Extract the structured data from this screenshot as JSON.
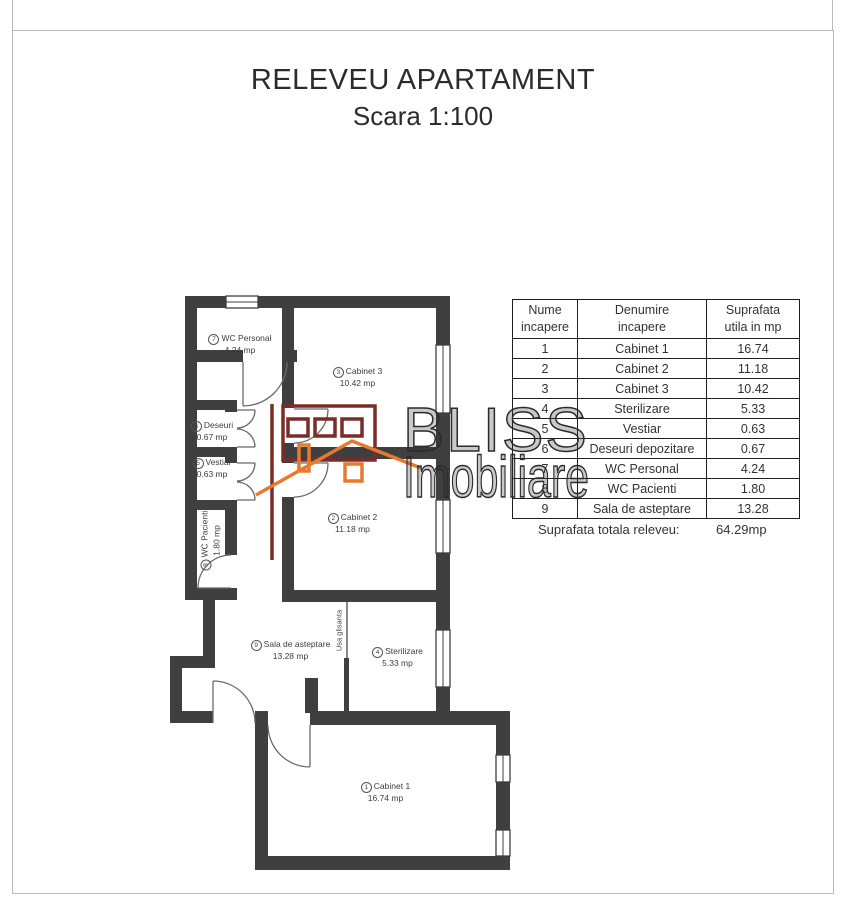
{
  "header": {
    "title": "RELEVEU APARTAMENT",
    "scale": "Scara 1:100"
  },
  "floor_plan": {
    "rooms": [
      {
        "badge": "7",
        "name": "WC Personal",
        "area": "4.24 mp"
      },
      {
        "badge": "3",
        "name": "Cabinet 3",
        "area": "10.42 mp"
      },
      {
        "badge": "6",
        "name": "Deseuri",
        "area": "0.67 mp"
      },
      {
        "badge": "5",
        "name": "Vestiar",
        "area": "0.63 mp"
      },
      {
        "badge": "8",
        "name": "WC Pacienti",
        "area": "1.80 mp"
      },
      {
        "badge": "2",
        "name": "Cabinet 2",
        "area": "11.18 mp"
      },
      {
        "badge": "9",
        "name": "Sala de asteptare",
        "area": "13.28 mp"
      },
      {
        "badge": "4",
        "name": "Sterilizare",
        "area": "5.33 mp"
      },
      {
        "badge": "1",
        "name": "Cabinet 1",
        "area": "16.74 mp"
      }
    ],
    "sliding_door_label": "Usa glisanta",
    "wall_color": "#3f3f3f"
  },
  "table": {
    "headers": [
      {
        "l1": "Nume",
        "l2": "incapere"
      },
      {
        "l1": "Denumire",
        "l2": "incapere"
      },
      {
        "l1": "Suprafata",
        "l2": "utila in mp"
      }
    ],
    "rows": [
      {
        "nr": "1",
        "name": "Cabinet 1",
        "area": "16.74"
      },
      {
        "nr": "2",
        "name": "Cabinet 2",
        "area": "11.18"
      },
      {
        "nr": "3",
        "name": "Cabinet 3",
        "area": "10.42"
      },
      {
        "nr": "4",
        "name": "Sterilizare",
        "area": "5.33"
      },
      {
        "nr": "5",
        "name": "Vestiar",
        "area": "0.63"
      },
      {
        "nr": "6",
        "name": "Deseuri depozitare",
        "area": "0.67"
      },
      {
        "nr": "7",
        "name": "WC Personal",
        "area": "4.24"
      },
      {
        "nr": "8",
        "name": "WC Pacienti",
        "area": "1.80"
      },
      {
        "nr": "9",
        "name": "Sala de asteptare",
        "area": "13.28"
      }
    ],
    "total_label": "Suprafata totala releveu:",
    "total_value": "64.29mp"
  },
  "watermark": {
    "line1": "BLISS",
    "line2": "Imobiliare",
    "logo_maroon": "#7b2b28",
    "logo_orange": "#e87a2e"
  }
}
